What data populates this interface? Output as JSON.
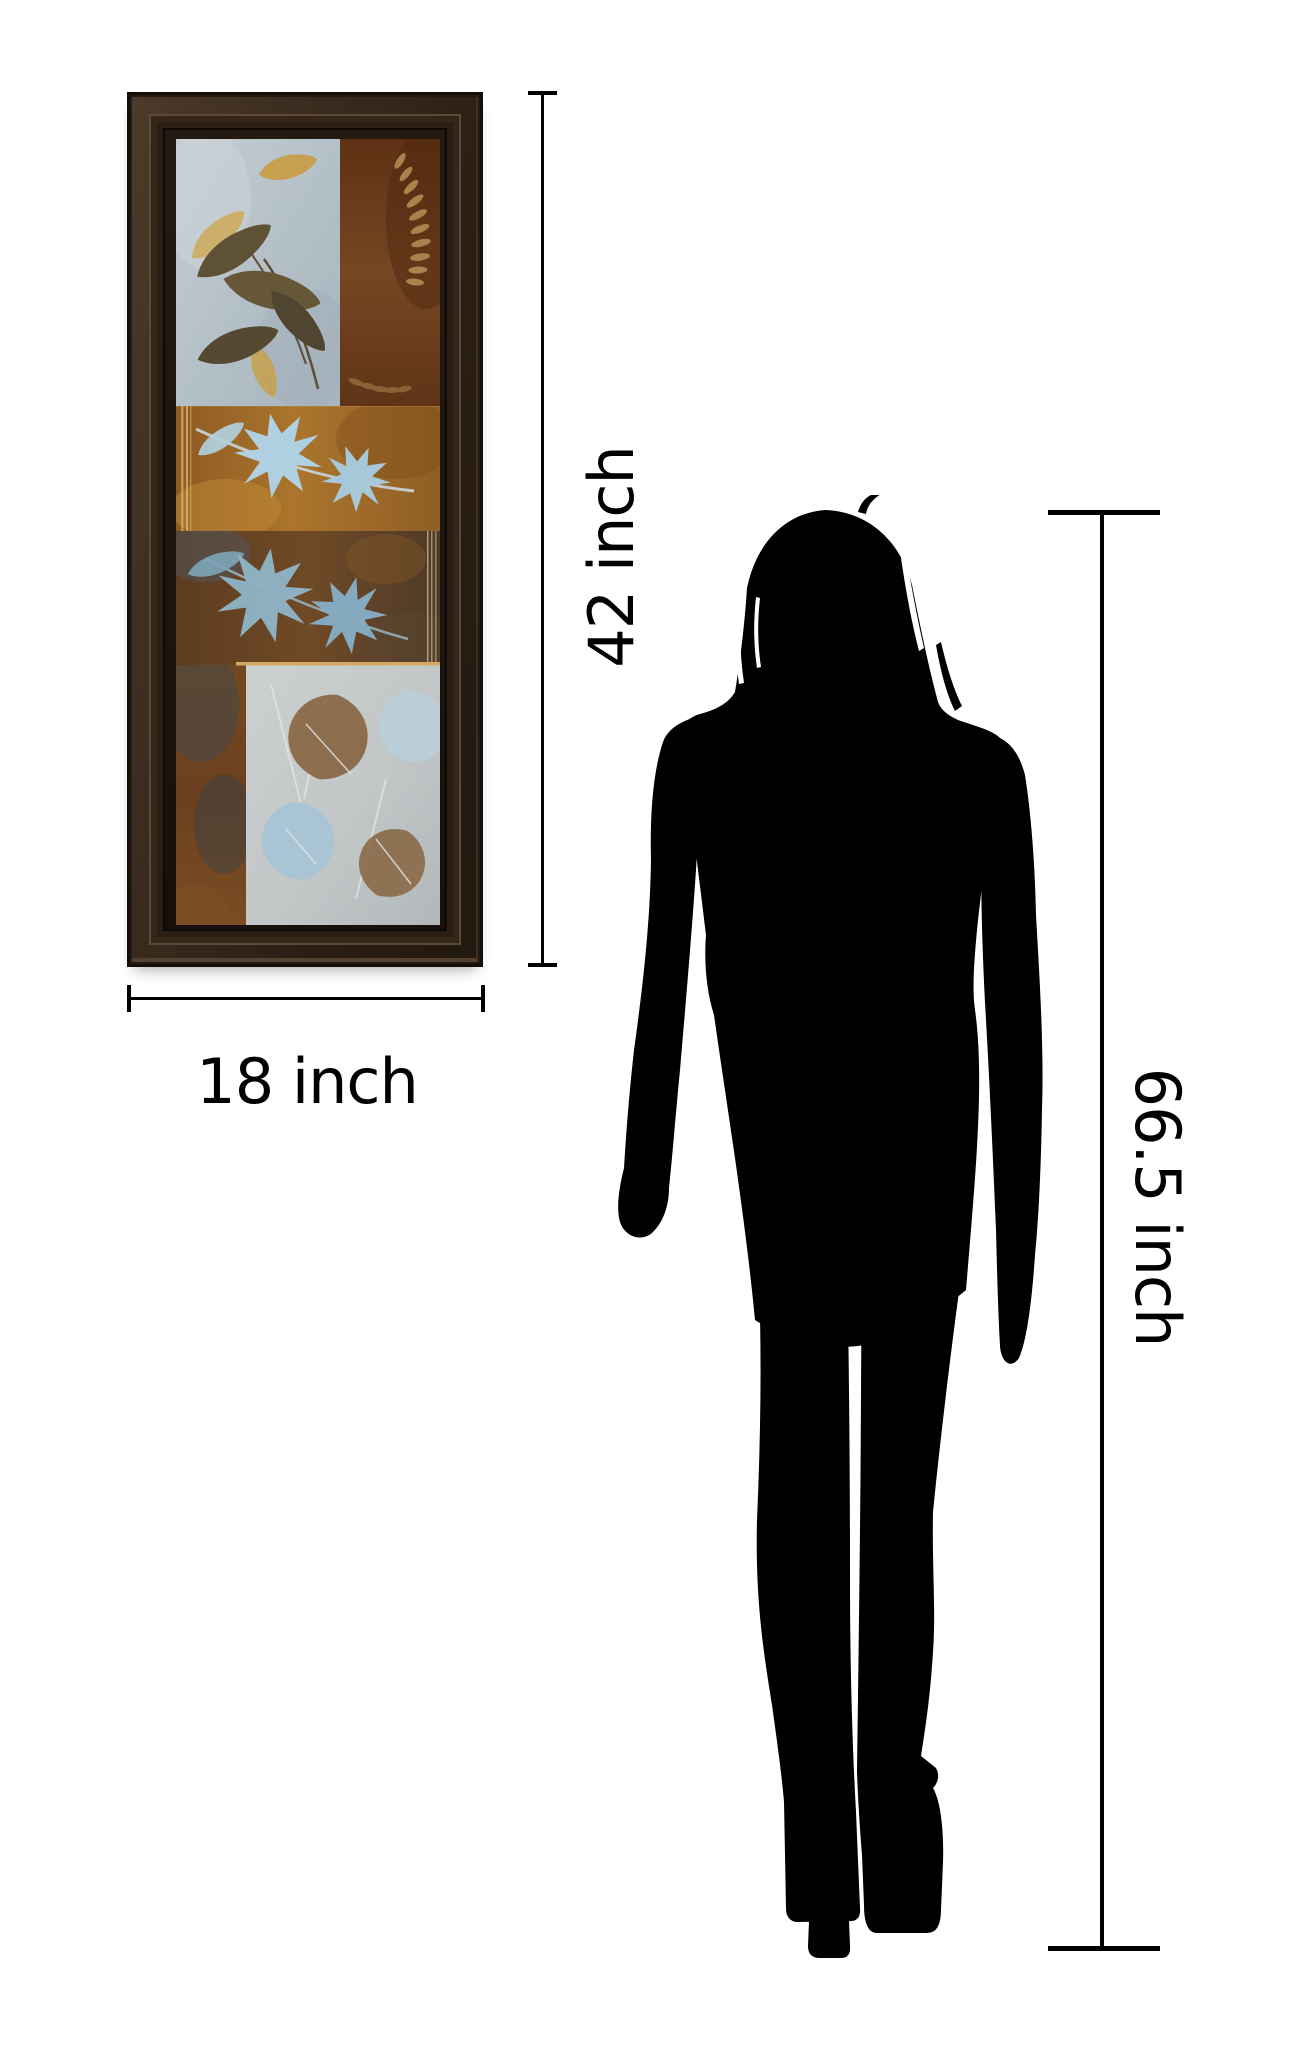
{
  "annotations": {
    "art_height": {
      "label": "42 inch"
    },
    "art_width": {
      "label": "18 inch"
    },
    "person_height": {
      "label": "66.5 inch"
    }
  },
  "colors": {
    "background": "#ffffff",
    "dimension_line": "#000000",
    "silhouette": "#000000",
    "frame_dark": "#231a13",
    "frame_mid": "#3a2b1e",
    "frame_highlight": "#5d4936",
    "panel_blue_gray": "#b9c4cb",
    "panel_brown": "#6f4120",
    "panel_amber": "#a26d2a",
    "panel_mottled": "#6a4523",
    "panel_rust": "#6e4423",
    "panel_silver": "#c6c9c9",
    "leaf_olive": "#5f5136",
    "leaf_gold": "#c99a45",
    "leaf_blue_light": "#aed0e0",
    "leaf_blue": "#8fb5c8",
    "leaf_brown": "#8a6a48",
    "gold_trim": "#d3a963"
  }
}
